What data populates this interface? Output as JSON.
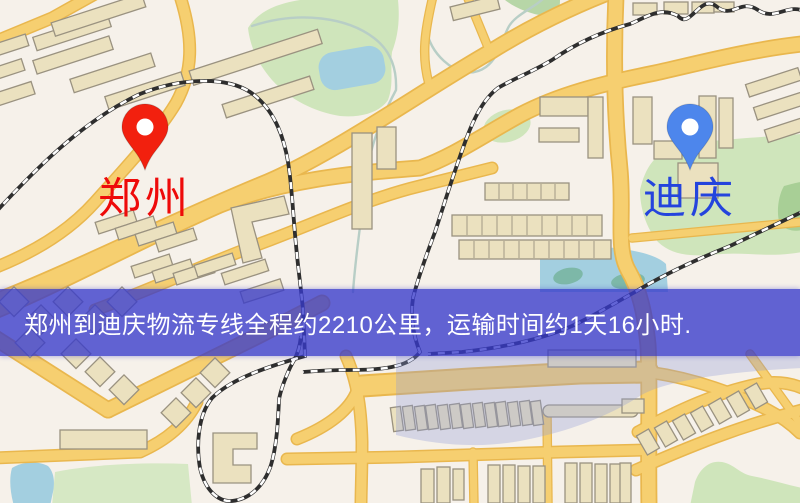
{
  "banner": {
    "text": "郑州到迪庆物流专线全程约2210公里，运输时间约1天16小时.",
    "background": "rgba(55,58,202,0.78)",
    "text_color": "#ffffff"
  },
  "markers": {
    "origin": {
      "name": "郑州",
      "label_color": "#ee0a0a",
      "pin_color": "#f2200e",
      "pin_hole_color": "#ffffff"
    },
    "destination": {
      "name": "迪庆",
      "label_color": "#2444dd",
      "pin_color": "#4d86ec",
      "pin_hole_color": "#ffffff"
    }
  },
  "palette": {
    "map-bg": "#f6f1ea",
    "road-fill": "#f6cf70",
    "road-casing": "#e9b74e",
    "building-fill": "#ebe1bf",
    "building-stroke": "#9a9280",
    "green": "#cfe5bb",
    "green-dark": "#a8cf96",
    "water": "#a3cfe0",
    "railway": "#2e2e2e",
    "wash": "#8f9ad8"
  }
}
